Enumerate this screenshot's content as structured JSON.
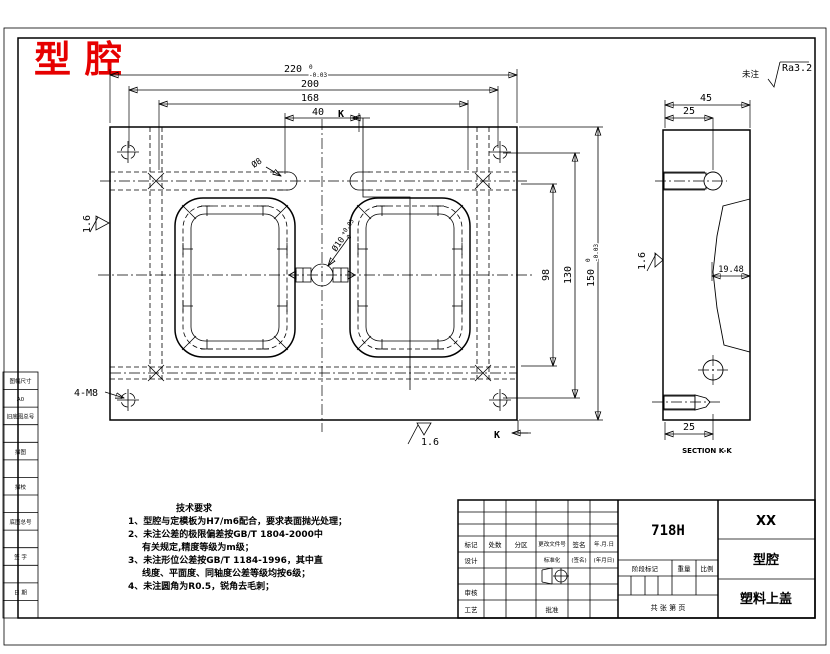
{
  "title": "型腔",
  "note": {
    "prefix": "未注",
    "roughness": "Ra3.2"
  },
  "dims": {
    "d220": "220",
    "d220_tu": "0",
    "d220_tl": "-0.03",
    "d200": "200",
    "d168": "168",
    "d40": "40",
    "d98": "98",
    "d130": "130",
    "d150": "150",
    "d150_tu": "0",
    "d150_tl": "-0.03",
    "thread": "4-M8",
    "dia8": "Ø8",
    "dia10": "Ø10",
    "dia10_tu": "+0.05",
    "dia10_tl": "0",
    "finish_left": "1.6",
    "finish_bottom": "1.6",
    "k": "K"
  },
  "section": {
    "d45": "45",
    "d25_top": "25",
    "d25_bottom": "25",
    "depth": "19.48",
    "finish": "1.6",
    "caption": "SECTION K-K"
  },
  "tech": {
    "heading": "技术要求",
    "l1": "1、型腔与定模板为H7/m6配合，要求表面抛光处理；",
    "l2": "2、未注公差的极限偏差按GB/T 1804-2000中",
    "l3": "有关规定,精度等级为m级；",
    "l4": "3、未注形位公差按GB/T 1184-1996，其中直",
    "l5": "线度、平面度、同轴度公差等级均按6级；",
    "l6": "4、未注圆角为R0.5，锐角去毛刺；"
  },
  "tb": {
    "material": "718H",
    "company": "XX",
    "part": "型腔",
    "product": "塑料上盖",
    "h_mark": "标记",
    "h_count": "处数",
    "h_zone": "分区",
    "h_doc": "更改文件号",
    "h_sign": "签名",
    "h_date": "年.月.日",
    "r_design": "设计",
    "r_std": "标准化",
    "r_sign": "(签名)",
    "r_date": "(年月日)",
    "r_check": "审核",
    "r_proc": "工艺",
    "r_appr": "批准",
    "s_stage": "阶段标记",
    "s_weight": "重量",
    "s_scale": "比例",
    "sheet": "共  张  第  页"
  },
  "margin": {
    "c1": "图幅尺寸",
    "c2": "A0",
    "c3": "旧底图总号",
    "c5": "描图",
    "c7": "描校",
    "c9": "底图总号",
    "c11": "签 字",
    "c13": "日 期"
  }
}
